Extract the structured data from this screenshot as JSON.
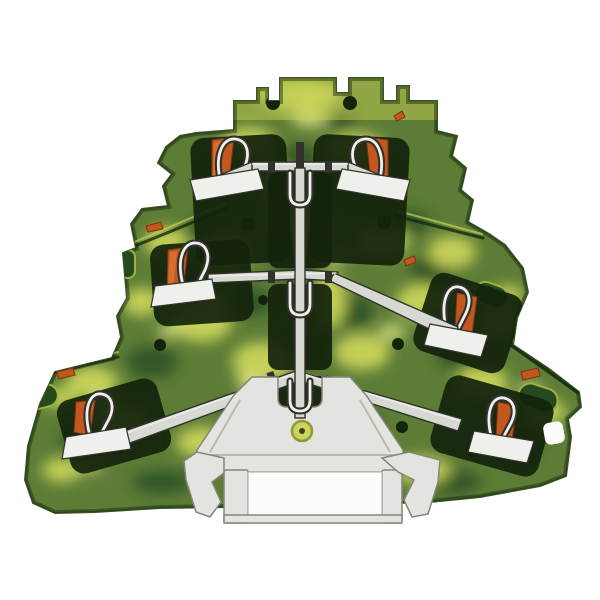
{
  "meta": {
    "subject": "Cutaway product photo of a three-level green-yellow PE ground terminal block on a white background"
  },
  "colors": {
    "background": "#ffffff",
    "housing_mid": "#5d7c36",
    "housing_edge": "#3c5524",
    "housing_top": "#c3cf52",
    "marble_yellow": "#cfd95b",
    "marble_bright": "#e9ed8d",
    "marble_dark": "#2c4f26",
    "chamber_dark": "#13230c",
    "slot_green": "#28481f",
    "slot_rim": "#9ab244",
    "clamp_orange": "#c2571f",
    "clamp_orange_dark": "#7e3413",
    "clamp_orange_light": "#db7435",
    "metal_light": "#d9d9d4",
    "metal_bright": "#efefeb",
    "metal_outline": "#32322c",
    "foot_gray": "#e3e3df",
    "foot_outline": "#85857c",
    "foot_shade": "#b8b8b1",
    "window_white": "#fcfcfa",
    "marker_yellow": "#ccd45c",
    "marker_ring": "#8e9a3a",
    "marker_dot": "#39431a",
    "seam_dark": "#15290f",
    "seam_highlight": "#c6d257"
  },
  "parts": [
    {
      "name": "housing",
      "desc": "marbled green-yellow insulating housing, three stacked levels"
    },
    {
      "name": "clamp-unit",
      "desc": "six spring clamp positions with orange release elements"
    },
    {
      "name": "busbar",
      "desc": "light metal busbars on each level converging to the center"
    },
    {
      "name": "center-link",
      "desc": "vertical link rod electrically joining all three levels"
    },
    {
      "name": "din-foot",
      "desc": "light gray DIN rail mounting foot with side latches and rail window"
    },
    {
      "name": "marker-point",
      "desc": "round yellow fixing point on the foot"
    }
  ],
  "texture": {
    "dark": [
      [
        230,
        182,
        28,
        20
      ],
      [
        370,
        182,
        28,
        20
      ],
      [
        300,
        158,
        22,
        12
      ],
      [
        182,
        282,
        24,
        16
      ],
      [
        432,
        272,
        22,
        16
      ],
      [
        300,
        268,
        26,
        14
      ],
      [
        252,
        302,
        20,
        14
      ],
      [
        352,
        312,
        22,
        16
      ],
      [
        152,
        362,
        26,
        16
      ],
      [
        462,
        352,
        26,
        18
      ],
      [
        252,
        412,
        28,
        18
      ],
      [
        352,
        422,
        26,
        16
      ],
      [
        520,
        440,
        22,
        14
      ],
      [
        82,
        442,
        22,
        14
      ],
      [
        302,
        352,
        22,
        14
      ],
      [
        202,
        232,
        18,
        12
      ],
      [
        412,
        222,
        18,
        12
      ],
      [
        300,
        482,
        42,
        14
      ],
      [
        162,
        482,
        30,
        12
      ],
      [
        452,
        482,
        30,
        12
      ],
      [
        262,
        138,
        16,
        10
      ],
      [
        340,
        120,
        18,
        10
      ]
    ],
    "yellow": [
      [
        300,
        95,
        42,
        16
      ],
      [
        250,
        142,
        26,
        15
      ],
      [
        356,
        150,
        30,
        17
      ],
      [
        300,
        226,
        30,
        20
      ],
      [
        226,
        252,
        26,
        18
      ],
      [
        166,
        242,
        22,
        14
      ],
      [
        382,
        242,
        26,
        16
      ],
      [
        452,
        252,
        24,
        16
      ],
      [
        202,
        322,
        30,
        20
      ],
      [
        142,
        302,
        20,
        14
      ],
      [
        422,
        302,
        26,
        18
      ],
      [
        500,
        322,
        22,
        14
      ],
      [
        92,
        382,
        26,
        16
      ],
      [
        262,
        362,
        30,
        20
      ],
      [
        362,
        352,
        28,
        18
      ],
      [
        482,
        382,
        26,
        16
      ],
      [
        546,
        412,
        20,
        13
      ],
      [
        122,
        422,
        28,
        18
      ],
      [
        202,
        442,
        26,
        15
      ],
      [
        422,
        470,
        28,
        14
      ],
      [
        62,
        470,
        20,
        12
      ],
      [
        330,
        300,
        16,
        28
      ],
      [
        272,
        182,
        14,
        22
      ],
      [
        318,
        92,
        20,
        10
      ],
      [
        508,
        296,
        16,
        10
      ],
      [
        60,
        398,
        18,
        10
      ]
    ],
    "bright": [
      [
        310,
        118,
        18,
        9
      ],
      [
        212,
        300,
        14,
        8
      ],
      [
        392,
        332,
        14,
        8
      ],
      [
        102,
        402,
        14,
        8
      ],
      [
        502,
        402,
        12,
        7
      ],
      [
        336,
        256,
        12,
        7
      ],
      [
        250,
        382,
        14,
        8
      ],
      [
        448,
        300,
        10,
        6
      ],
      [
        170,
        330,
        12,
        7
      ],
      [
        530,
        390,
        12,
        7
      ],
      [
        90,
        466,
        12,
        6
      ]
    ]
  }
}
